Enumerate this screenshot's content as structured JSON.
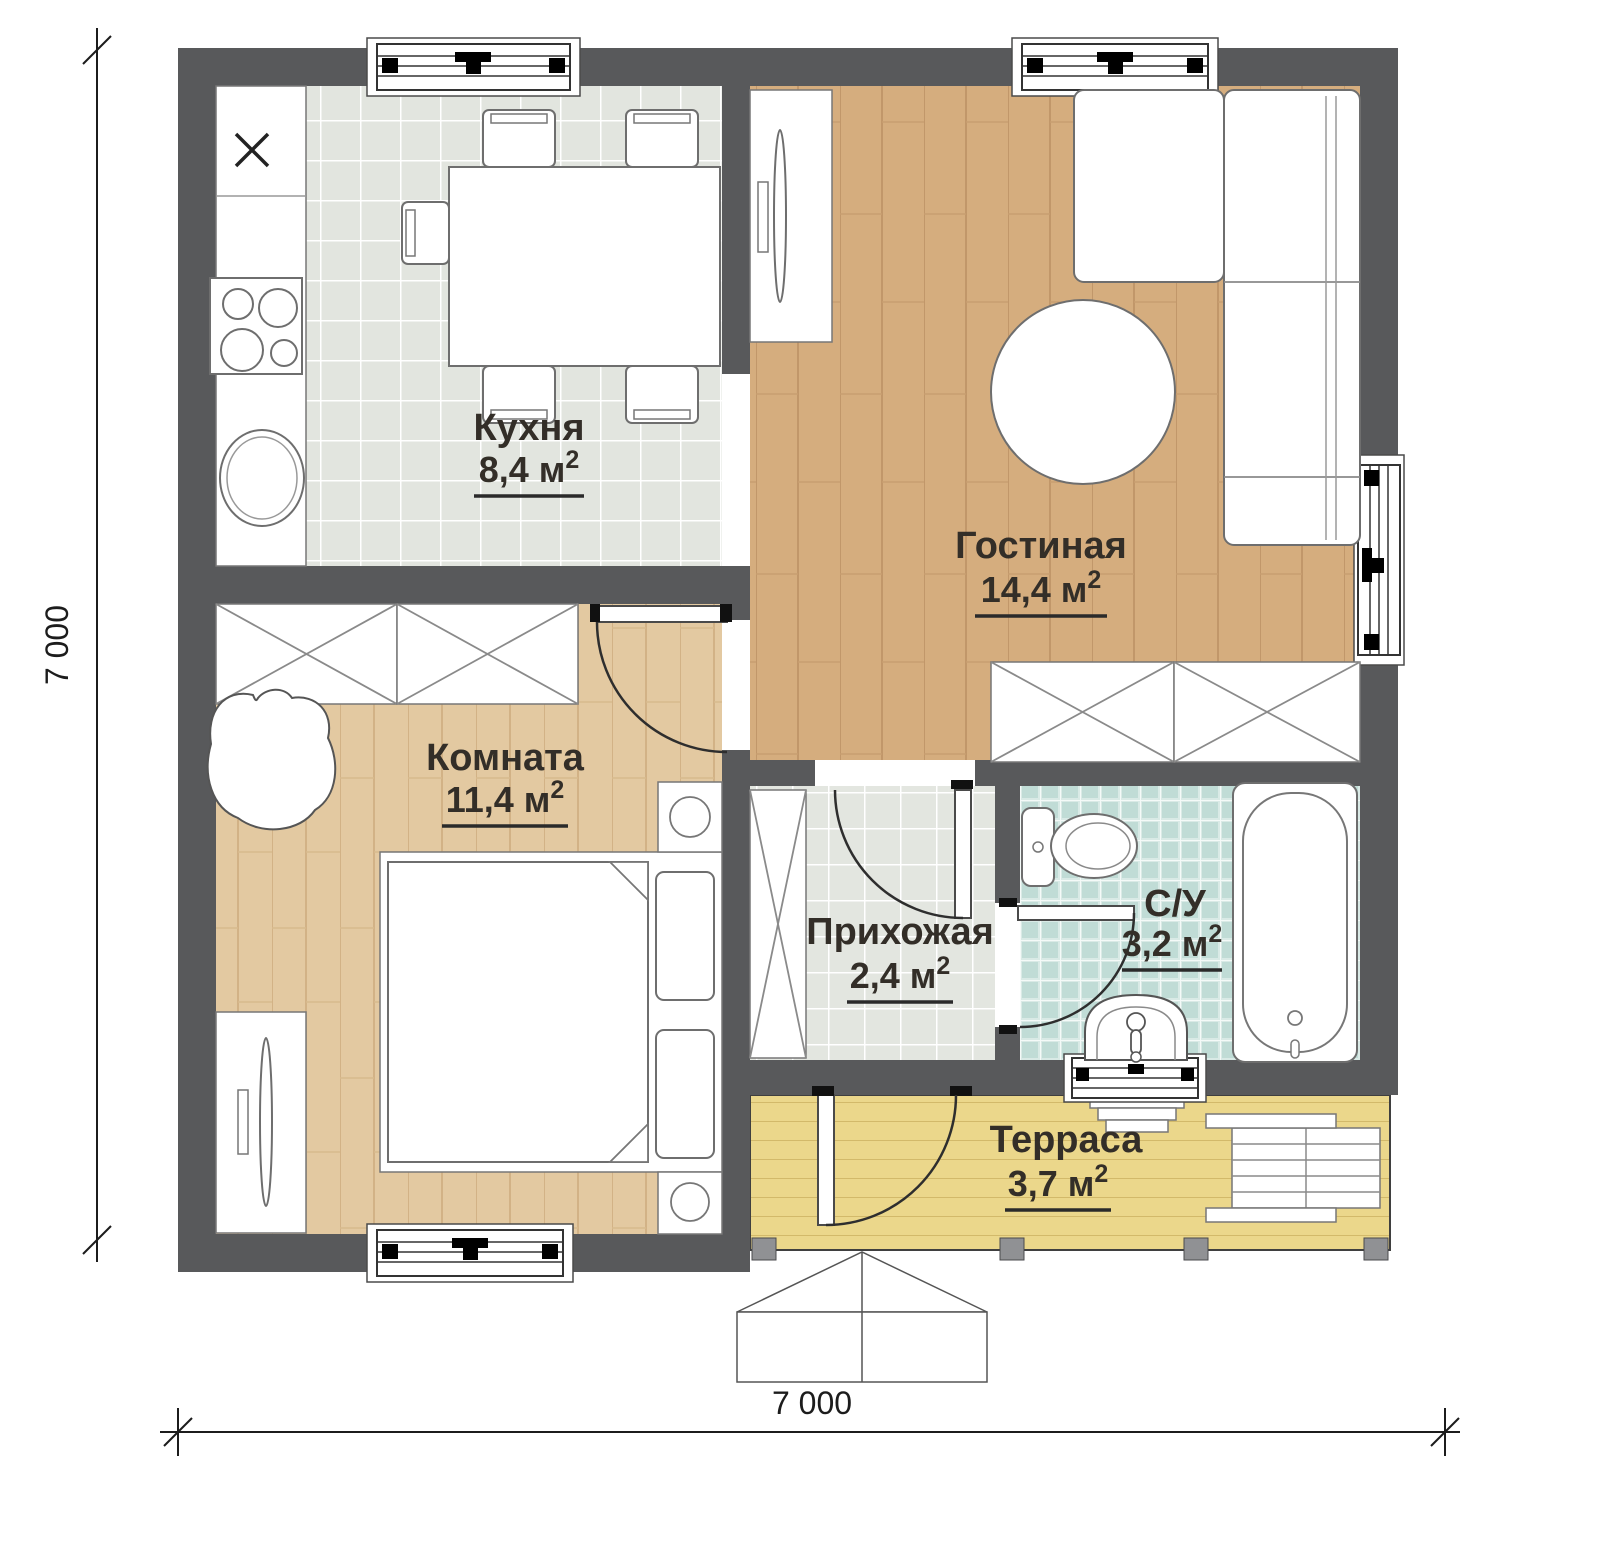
{
  "plan": {
    "rooms": [
      {
        "id": "kitchen",
        "name": "Кухня",
        "area": "8,4 м",
        "area_sup": "2"
      },
      {
        "id": "living",
        "name": "Гостиная",
        "area": "14,4 м",
        "area_sup": "2"
      },
      {
        "id": "bedroom",
        "name": "Комната",
        "area": "11,4 м",
        "area_sup": "2"
      },
      {
        "id": "hallway",
        "name": "Прихожая",
        "area": "2,4 м",
        "area_sup": "2"
      },
      {
        "id": "bathroom",
        "name": "С/У",
        "area": "3,2 м",
        "area_sup": "2"
      },
      {
        "id": "terrace",
        "name": "Терраса",
        "area": "3,7 м",
        "area_sup": "2"
      }
    ],
    "dimensions": {
      "width_label": "7 000",
      "height_label": "7 000"
    },
    "colors": {
      "wall": "#58595b",
      "kitchen_tile": "#e2e5df",
      "hallway_tile": "#e3e6e0",
      "bathroom_tile": "#cfe4df",
      "living_wood": "#d5ad7e",
      "bedroom_wood": "#e3c9a1",
      "terrace_wood": "#ebd78b",
      "furniture_outline": "#6e6e6e",
      "label_text": "#332e28"
    }
  }
}
